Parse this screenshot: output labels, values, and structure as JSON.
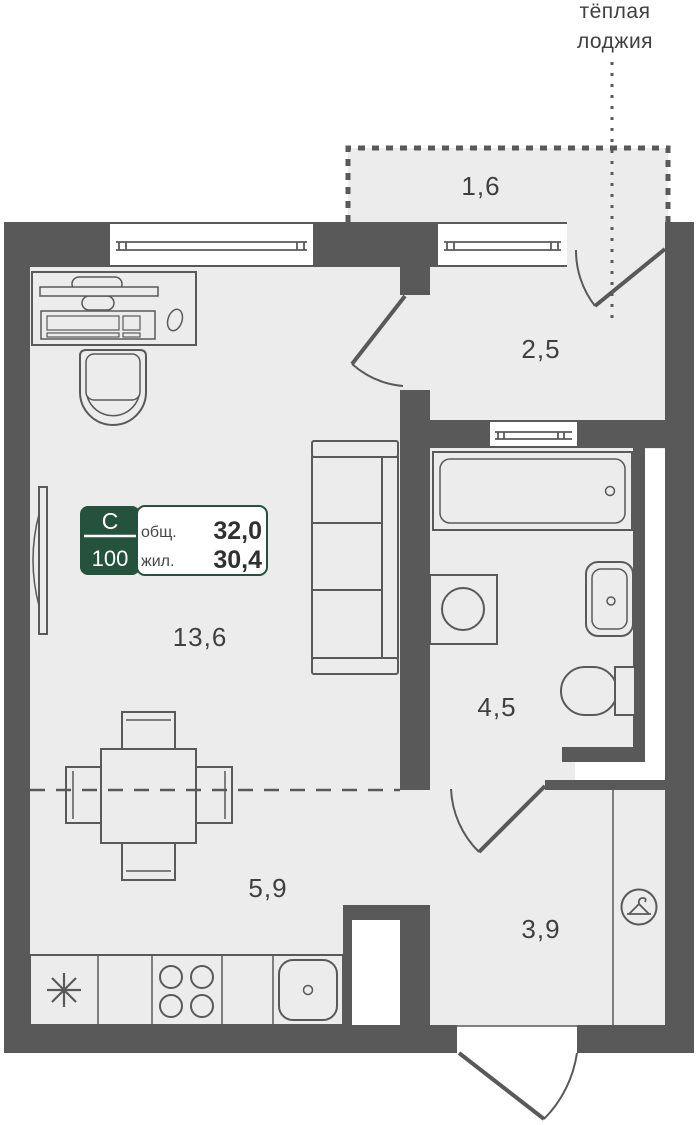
{
  "header": {
    "loggia_line1": "тёплая",
    "loggia_line2": "лоджия"
  },
  "apartment_badge": {
    "building_letter": "С",
    "unit_number": "100",
    "total_label": "общ.",
    "total_value": "32,0",
    "living_label": "жил.",
    "living_value": "30,4"
  },
  "room_areas": {
    "loggia": "1,6",
    "hallway": "2,5",
    "living_room": "13,6",
    "bathroom": "4,5",
    "kitchen": "5,9",
    "corridor": "3,9"
  },
  "colors": {
    "walls": "#595959",
    "floor": "#ECECEC",
    "badge_green": "#24523C",
    "label_text": "#3F3F3F",
    "background": "#FFFFFF"
  }
}
